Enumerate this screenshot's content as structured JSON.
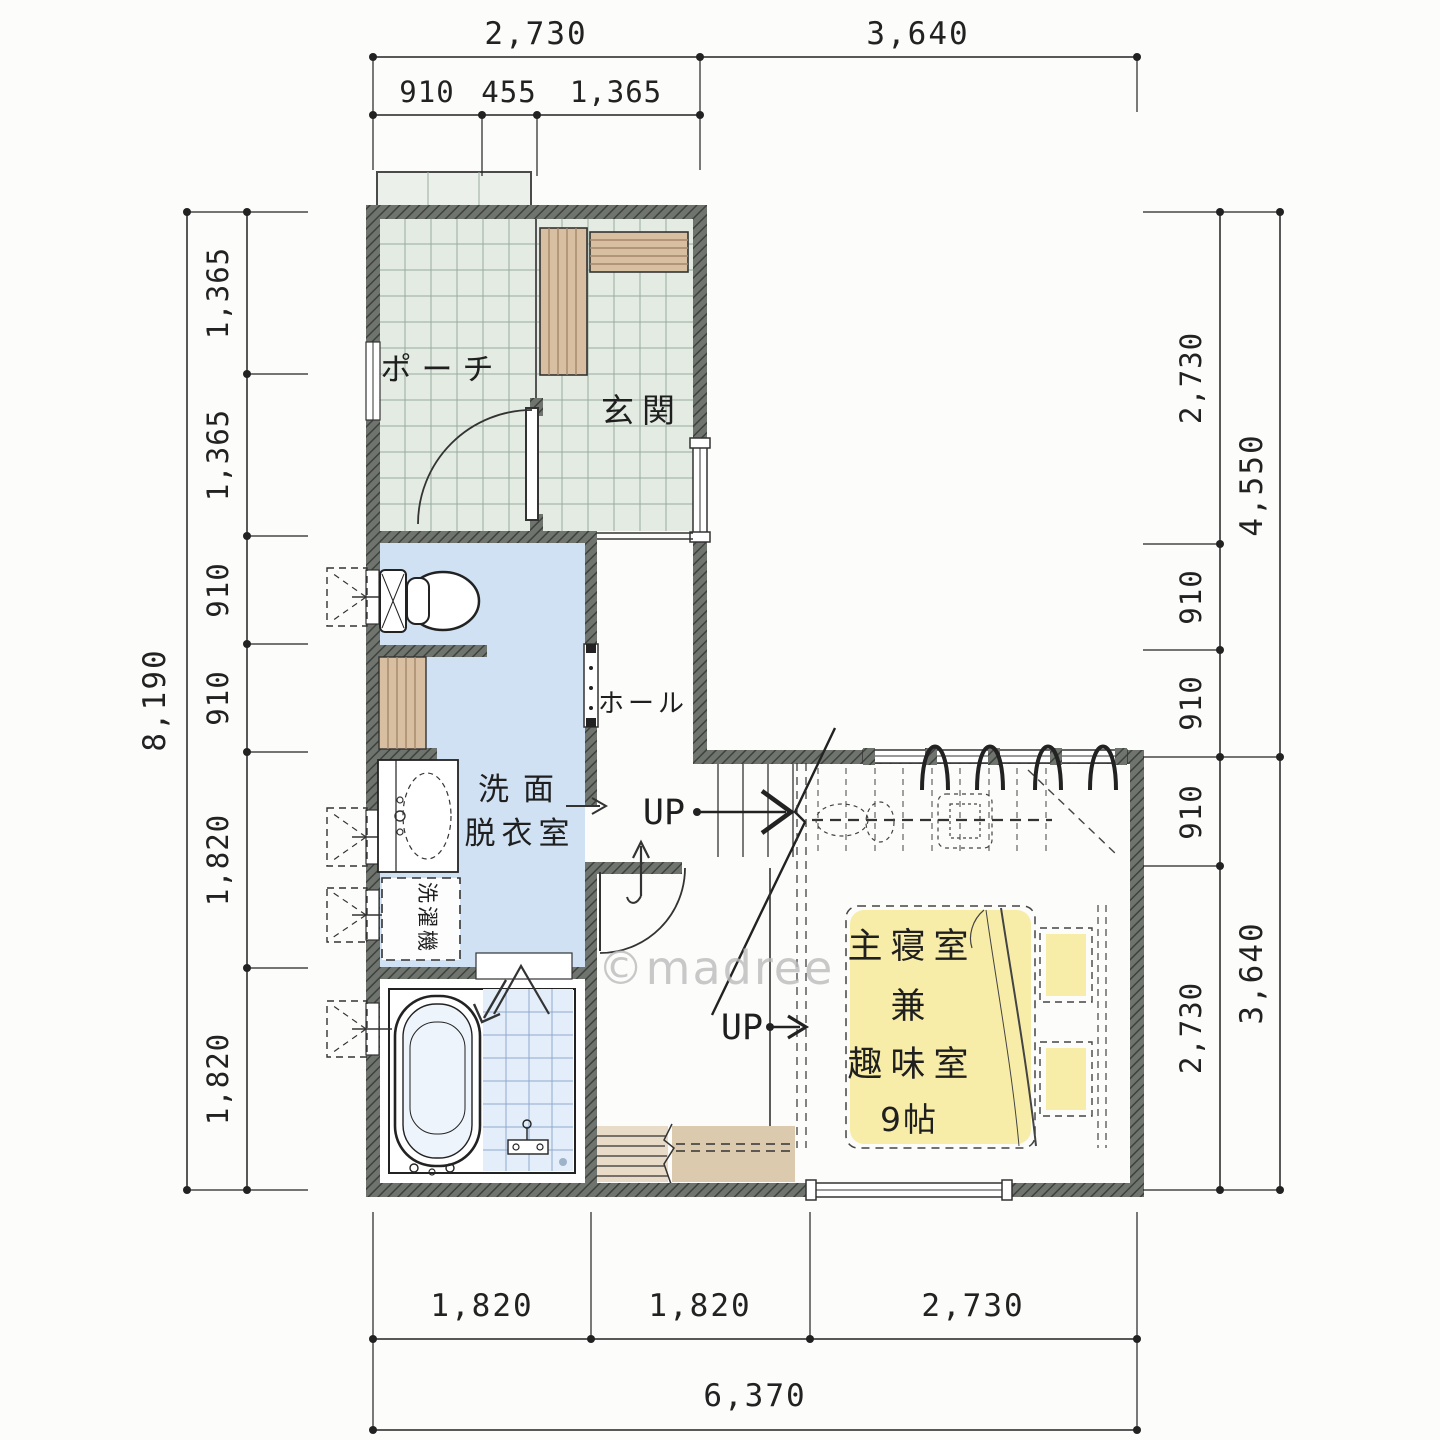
{
  "watermark": "©madree",
  "rooms": {
    "porch": "ポーチ",
    "entry": "玄関",
    "hall": "ホール",
    "washroom_line1": "洗面",
    "washroom_line2": "脱衣室",
    "laundry": "洗濯機",
    "bedroom_line1": "主寝室",
    "bedroom_line2": "兼",
    "bedroom_line3": "趣味室",
    "bedroom_size": "9帖",
    "up_label_1": "UP",
    "up_label_2": "UP"
  },
  "dimensions": {
    "top": [
      "2,730",
      "3,640"
    ],
    "top_sub": [
      "910",
      "455",
      "1,365"
    ],
    "left_total": "8,190",
    "left": [
      "1,365",
      "1,365",
      "910",
      "910",
      "1,820",
      "1,820"
    ],
    "right": [
      "2,730",
      "910",
      "910",
      "910",
      "2,730"
    ],
    "right_outer": [
      "4,550",
      "3,640"
    ],
    "bottom": [
      "1,820",
      "1,820",
      "2,730"
    ],
    "bottom_total": "6,370"
  },
  "colors": {
    "wall": "#70746e",
    "tile_green": "#e3ebe3",
    "water_blue": "#cfe1f3",
    "shower_blue": "#e4eefa",
    "tatami_yellow": "#f8eda8",
    "wood_tan": "#d8bfa2"
  }
}
